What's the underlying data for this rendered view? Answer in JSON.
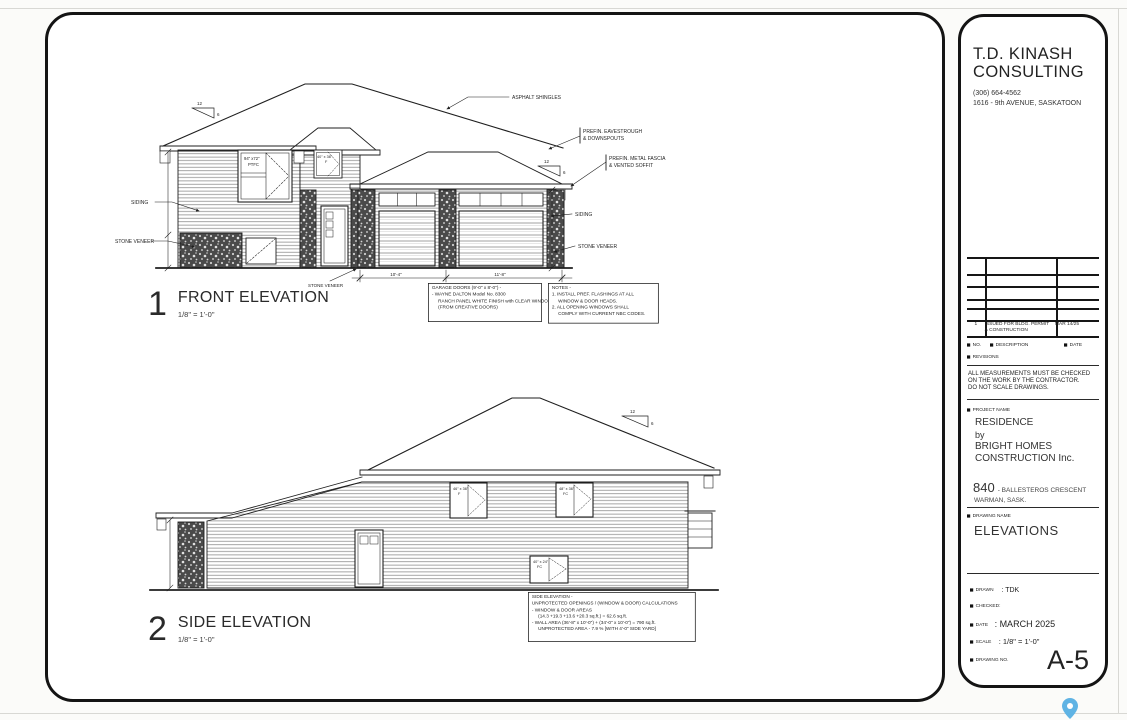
{
  "colors": {
    "pin": "#5fb3e4",
    "linework": "#1f1f1f",
    "paper": "#ffffff"
  },
  "front": {
    "num": "1",
    "title": "FRONT ELEVATION",
    "scale": "1/8\" = 1'-0\"",
    "shingles": "ASPHALT SHINGLES",
    "eaves1": "PREFIN. EAVESTROUGH",
    "eaves2": "& DOWNSPOUTS",
    "fascia1": "PREFIN. METAL FASCIA",
    "fascia2": "& VENTED SOFFIT",
    "siding_left": "SIDING",
    "siding_right": "SIDING",
    "stone_left": "STONE VENEER",
    "stone_right": "STONE VENEER",
    "stone_center": "STONE VENEER",
    "win_main_size": "94\" x72\"",
    "win_main_type": "PTFC",
    "win_entry_size": "40\" x 36\"",
    "win_entry_type": "F",
    "slope_run": "12",
    "slope_rise": "6",
    "dim1": "10'-4\"",
    "dim2": "11'-8\"",
    "garage_box": [
      "GARAGE DOORS (9'-0\" x 8'-0\") -",
      "- WAYNE DALTON Model No. 8300",
      "RANCH PANEL WHITE FINISH with CLEAR WINDOWS",
      "(FROM CREATIVE DOORS)"
    ],
    "notes_box": [
      "NOTES -",
      "1. INSTALL PREF. FLASHINGS AT ALL",
      "WINDOW & DOOR HEADS.",
      "2. ALL OPENING WINDOWS SHALL",
      "COMPLY WITH CURRENT NBC CODES."
    ]
  },
  "side": {
    "num": "2",
    "title": "SIDE ELEVATION",
    "scale": "1/8\" = 1'-0\"",
    "win1_size": "46\" x 36\"",
    "win1_type": "F",
    "win2_size": "48\" x 36\"",
    "win2_type": "FC",
    "win3_size": "40\" x 24\"",
    "win3_type": "FC",
    "slope_run": "12",
    "slope_rise": "6",
    "calc_box": [
      "SIDE ELEVATION -",
      "UNPROTECTED OPENINGS / (WINDOW & DOOR) CALCULATIONS",
      "- WINDOW & DOOR AREAS",
      "(14.3 +19.3 +13.6 +20.3 sq.ft.) = 62.6 sq.ft.",
      "- WALL AREA (36'-8\" x 10'-0\") + (34'-0\" x 10'-0\") = 790 sq.ft.",
      "UNPROTECTED AREA - 7.9 % [WITH 4'-0\" SIDE YARD]"
    ]
  },
  "tb": {
    "firm_line1": "T.D. KINASH",
    "firm_line2": "CONSULTING",
    "phone": "(306) 664-4562",
    "address": "1616 - 9th AVENUE, SASKATOON",
    "rev_no": "1",
    "rev_desc1": "ISSUED FOR BLDG. PERMIT",
    "rev_desc2": "& CONSTRUCTION",
    "rev_date": "MAR 14/25",
    "col_no": "NO.",
    "col_desc": "DESCRIPTION",
    "col_date": "DATE",
    "revisions_label": "REVISIONS",
    "disclaimer1": "ALL MEASUREMENTS MUST BE CHECKED",
    "disclaimer2": "ON THE WORK BY THE CONTRACTOR.",
    "disclaimer3": "DO NOT SCALE DRAWINGS.",
    "project_label": "PROJECT NAME",
    "project1": "RESIDENCE",
    "project2": "by",
    "project3": "BRIGHT HOMES",
    "project4": "CONSTRUCTION Inc.",
    "site_number": "840",
    "site_street": "- BALLESTEROS CRESCENT",
    "site_city": "WARMAN, SASK.",
    "drawing_label": "DRAWING NAME",
    "drawing_name": "ELEVATIONS",
    "drawn_label": "DRAWN",
    "drawn_value": ":  TDK",
    "checked_label": "CHECKED:",
    "date_label": "DATE",
    "date_value": ":  MARCH 2025",
    "scale_label": "SCALE",
    "scale_value": ":   1/8\" = 1'-0\"",
    "dwg_label": "DRAWING NO.",
    "dwg_no": "A-5"
  }
}
